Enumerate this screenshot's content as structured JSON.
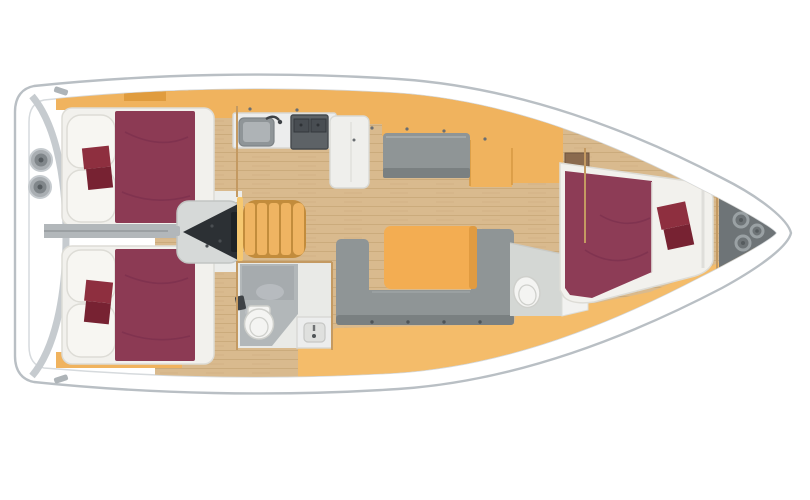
{
  "meta": {
    "description": "Top-down interior floor plan of a sailing yacht: two aft double cabins with maroon berths, amidships galley with sink and stove, U-shaped salon sofa with table, two heads with toilets, forward V-berth cabin and bow anchor locker with rope coils",
    "orientation": "bow-right"
  },
  "colors": {
    "background": "#ffffff",
    "hullStroke": "#b9bfc4",
    "deckLine": "#d6dadd",
    "transomBand": "#c6cbcf",
    "cleat": "#aeb4b8",
    "winchOuter": "#a9aeb2",
    "winchInner": "#80868a",
    "winchDot": "#565c60",
    "woodFloor": "#d9ba8e",
    "woodGrain": "#cbab7c",
    "cabinetOrange": "#f0b35e",
    "cabinetOrangeDark": "#dd9838",
    "cabinetEdge": "#d89a44",
    "floorOrange": "#f4bc6a",
    "shelfBrown": "#8a6a4e",
    "mattressWhite": "#f2f1ed",
    "pillowWhite": "#f7f6f2",
    "pillowStroke": "#dddcd6",
    "bedMaroon": "#8c3a54",
    "bedMaroonFwd": "#8d3c56",
    "bedMaroonDark": "#73294a",
    "cushionRed": "#8e2f3f",
    "cushionRedDark": "#772232",
    "sofaGray": "#8f9596",
    "sofaGrayDark": "#7a8081",
    "sofaGrayLight": "#a2a8a9",
    "benchDot": "#4f5457",
    "tableOrange": "#f3ad52",
    "tableShade": "#e09b41",
    "counterWhite": "#eceded",
    "counterStroke": "#d8d8d4",
    "sinkOuter": "#8f9598",
    "sinkInner": "#aeb3b6",
    "faucetDark": "#3e4246",
    "stoveDark": "#5d6266",
    "stoveGrate": "#484d52",
    "islandWhite": "#efefec",
    "handleDot": "#6a6e72",
    "engineHousing": "#d6d9d8",
    "engineDark": "#2c3034",
    "shaftGray": "#b2b7ba",
    "corridorWhite": "#ecedeb",
    "stairOrange": "#efb462",
    "stairGap": "#c28c3c",
    "stairEdge": "#f6c870",
    "headBase": "#e9eae7",
    "headFloor": "#b2b7b9",
    "headWall": "#a3a8ab",
    "headMottle": "#c3c7c9",
    "toiletBody": "#f4f4f2",
    "toiletEdge": "#cfd0cc",
    "basin": "#dfe0de",
    "headUnitSide": "#d4d7d4",
    "headUnitFront": "#f2f2f0",
    "anchorGray": "#6e7477",
    "ropeGray": "#9aa1a4",
    "ropeDot": "#565c5f",
    "bulkheadTan": "#c49a62"
  },
  "counts": {
    "aft_cabins": 2,
    "forward_cabins": 1,
    "heads": 2,
    "rope_coils": 3,
    "stern_winches": 2,
    "stair_treads": 5
  }
}
